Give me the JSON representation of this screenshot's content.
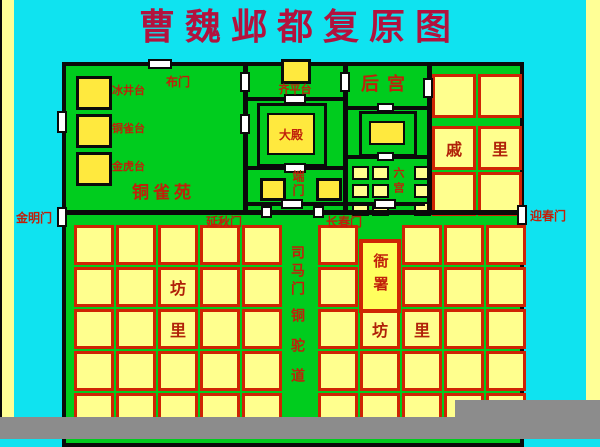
{
  "title": "曹魏邺都复原图",
  "legend": {
    "items": [
      {
        "label": "冰井台"
      },
      {
        "label": "铜雀台"
      },
      {
        "label": "金虎台"
      }
    ]
  },
  "garden": {
    "label": "铜雀苑"
  },
  "palace": {
    "north_gate_label": "布门",
    "platform_label": "齐平台",
    "main_hall_label": "大殿",
    "duan_gate_label": "端门",
    "rear_palace_label": "后宫",
    "six_palaces_label": "六宫"
  },
  "outer_gates": {
    "west": "金明门",
    "east": "迎春门"
  },
  "inner_gates": {
    "yanqiu": "延秋门",
    "changchun": "长春门",
    "sima": "司马门"
  },
  "road": {
    "label": "铜驼道"
  },
  "office": {
    "label": "衙署"
  },
  "qili": {
    "grid": {
      "cols": [
        432,
        478
      ],
      "rows": [
        74,
        126,
        172
      ],
      "w": 38,
      "h": 38
    },
    "labels": [
      {
        "col": 0,
        "row": 1,
        "char": "戚"
      },
      {
        "col": 1,
        "row": 1,
        "char": "里"
      }
    ]
  },
  "city": {
    "left_cols": [
      74,
      116,
      158,
      200,
      242
    ],
    "right_cols": [
      318,
      360,
      402,
      444,
      486
    ],
    "rows": [
      225,
      267,
      309,
      351,
      393
    ],
    "w": 34,
    "h": 34,
    "skip_right": [
      [
        1,
        0
      ],
      [
        1,
        1
      ]
    ],
    "labels": [
      {
        "side": "left",
        "col": 2,
        "row": 1,
        "char": "坊"
      },
      {
        "side": "left",
        "col": 2,
        "row": 2,
        "char": "里"
      },
      {
        "side": "right",
        "col": 1,
        "row": 2,
        "char": "坊"
      },
      {
        "side": "right",
        "col": 2,
        "row": 2,
        "char": "里"
      }
    ]
  },
  "six_squares": {
    "cols": [
      352,
      372,
      414
    ],
    "rows": [
      166,
      184,
      202
    ],
    "w": 13,
    "h": 10
  },
  "colors": {
    "background": "#0fe3f0",
    "ground_green": "#00cc1e",
    "block_fill": "#ffff8e",
    "block_border": "#cf2404",
    "bright_yellow": "#ffe93e",
    "label_red": "#c0200a",
    "title_red": "#b2123e",
    "wall_black": "#0a0a0a",
    "cutoff_gray": "#8c8c8c"
  }
}
